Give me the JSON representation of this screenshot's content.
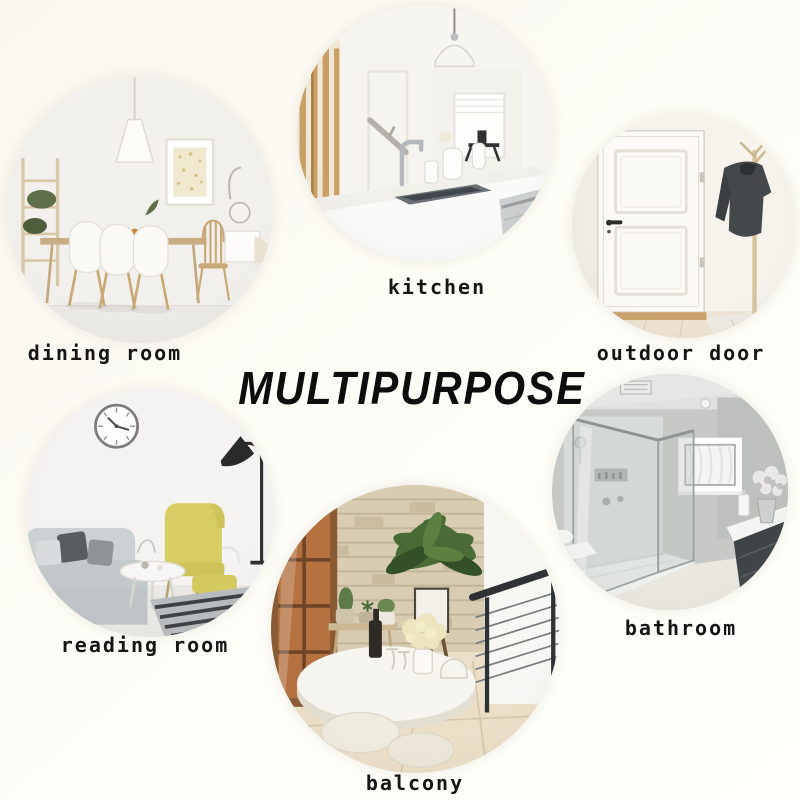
{
  "title": {
    "text": "MULTIPURPOSE"
  },
  "rooms": [
    {
      "id": "dining-room",
      "label": "dining room"
    },
    {
      "id": "kitchen",
      "label": "kitchen"
    },
    {
      "id": "outdoor-door",
      "label": "outdoor door"
    },
    {
      "id": "reading-room",
      "label": "reading room"
    },
    {
      "id": "balcony",
      "label": "balcony"
    },
    {
      "id": "bathroom",
      "label": "bathroom"
    }
  ],
  "colors": {
    "background": "#fbf9f2",
    "label_text": "#151515",
    "title_text": "#0d0d0d",
    "wood_accent": "#c9a06b",
    "yellow_chair": "#d8cd64",
    "plant_green": "#4a6b35",
    "stone_wall": "#d8cdb2",
    "jacket_gray": "#45484a"
  }
}
